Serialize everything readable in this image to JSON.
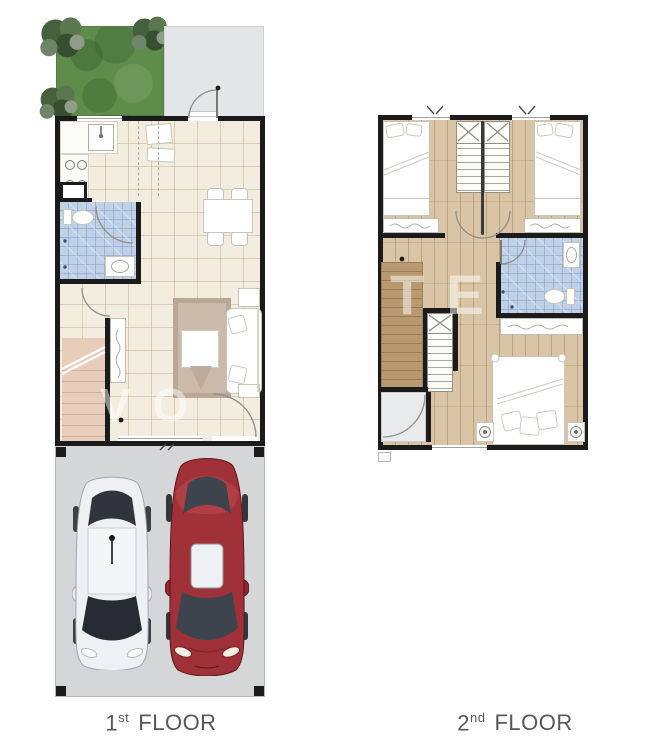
{
  "labels": {
    "floor1": {
      "number": "1",
      "ordinal": "st",
      "word": "FLOOR"
    },
    "floor2": {
      "number": "2",
      "ordinal": "nd",
      "word": "FLOOR"
    }
  },
  "watermark": {
    "floor1": "VO",
    "floor2": "TE"
  },
  "colors": {
    "wall": "#1b1b1b",
    "grass": "#5e8c4b",
    "patio": "#e3e5e7",
    "tile_floor": "#f2edde",
    "tile_line": "#ded2b8",
    "bath_tile": "#bfd1e7",
    "bath_line": "#a3bbd8",
    "wood_floor": "#d9c5a5",
    "wood_line": "#c0a67f",
    "closet_wood": "#b8996f",
    "stair_tan": "#e8cdbb",
    "stair_tread": "#cfae9b",
    "garage_floor": "#d4d6d8",
    "car_red": "#a03138",
    "car_white": "#eef0f3",
    "glass": "#343a43",
    "label_text": "#585858",
    "furniture_line": "#c6c6bc"
  }
}
